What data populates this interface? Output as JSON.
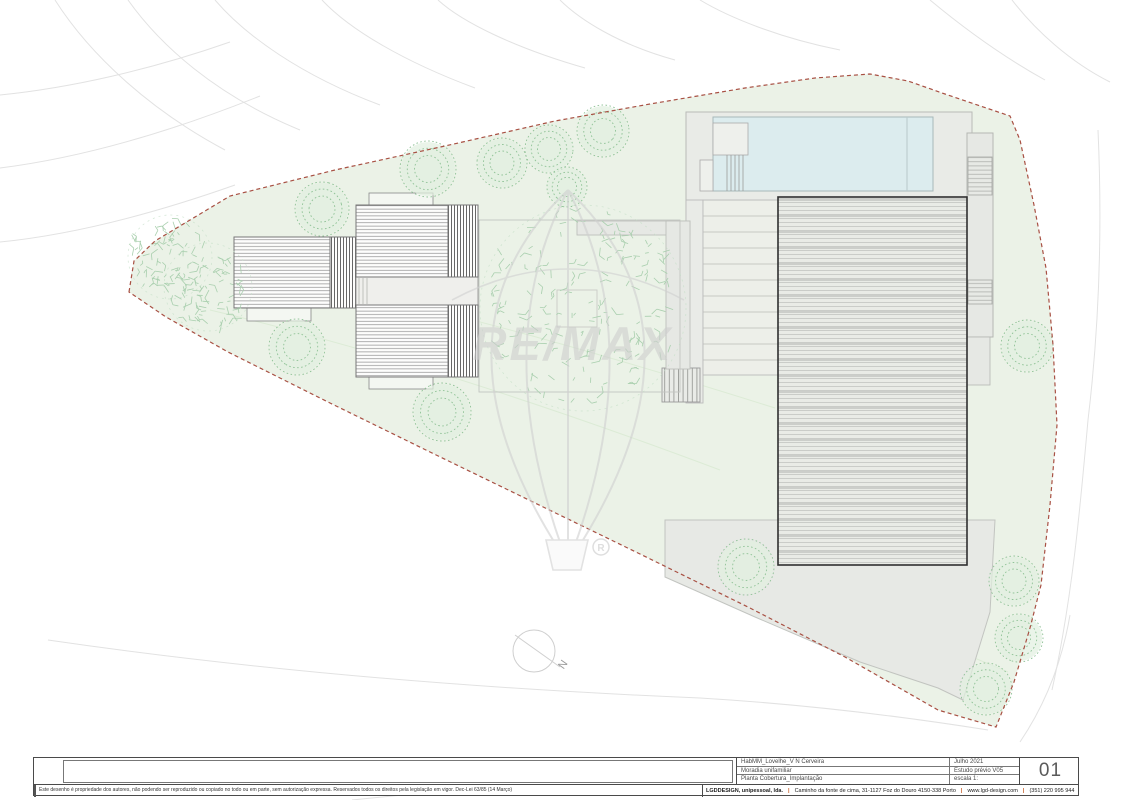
{
  "meta": {
    "sheet_number": "01",
    "north_label": "N"
  },
  "watermark": {
    "brand": "RE/MAX",
    "registered": "R"
  },
  "title_block": {
    "project": "HabMM_Lovelhe_V N Cerveira",
    "building_type": "Moradia unifamiliar",
    "drawing_title": "Planta Cobertura_Implantação",
    "date": "Julho 2021",
    "phase": "Estudo prévio V05",
    "scale": "escala 1:",
    "sheet_number": "01",
    "disclaimer": "Este desenho é propriedade dos autores, não podendo ser reproduzido ou copiado no todo ou em parte, sem autorização expressa. Reservados todos os direitos pela legislação em vigor. Dec-Lei 63/85 (14 Março)",
    "company": "LGDDESIGN, unipessoal, lda.",
    "address": "Caminho da fonte de cima, 31-1127   Foz do Douro   4150-338 Porto",
    "website": "www.lgd-design.com",
    "phone": "(351) 220 995 944",
    "separator": "|"
  },
  "palette": {
    "site_green": "#ebf2e7",
    "boundary_red": "#a85043",
    "pool_blue": "#dcecee",
    "roof_gray": "#e9ebe6",
    "tree_green": "#8fc296",
    "sketch_green": "#a9cfae",
    "contour_gray": "#e2e2e2",
    "watermark_gray": "#d0d0d0"
  },
  "drawing": {
    "site_polygon": "129,292 134,261 155,241 230,196 335,170 445,146 555,121 650,104 745,88 815,78 870,74 908,81 945,94 1010,116 1020,140 1034,205 1046,268 1053,345 1057,425 1050,505 1041,585 1030,628 1014,682 996,727 938,710 845,657 748,607 640,554 535,503 430,452 330,403 228,352 166,317",
    "contours": [
      "M 55,0 C 90,55 150,110 225,150",
      "M 128,0 C 160,45 215,95 300,130",
      "M 215,0 C 245,35 300,75 380,105",
      "M 322,0 C 350,30 405,62 475,88",
      "M 438,0 C 462,22 515,48 585,68",
      "M 0,95 C 70,88 150,70 230,42",
      "M 0,168 C 80,158 170,132 260,96",
      "M 0,242 C 70,235 150,215 235,185",
      "M 560,0 C 580,20 620,45 675,60",
      "M 700,0 C 730,18 780,38 840,50",
      "M 930,0 C 960,25 1000,55 1045,80",
      "M 1012,0 C 1035,30 1070,62 1110,82",
      "M 1098,130 C 1102,220 1100,320 1088,420",
      "M 1088,420 C 1080,510 1072,600 1052,690",
      "M 48,640 C 240,668 460,688 700,698",
      "M 700,698 C 800,704 900,716 988,730",
      "M 72,758 C 280,766 500,770 710,764",
      "M 352,800 C 470,788 600,778 716,770",
      "M 1020,742 C 1045,705 1062,662 1070,615"
    ],
    "green_contours": [
      "M 210,310 C 380,350 560,410 720,470",
      "M 262,272 C 430,304 610,356 775,408",
      "M 820,600 C 900,626 960,652 1008,672"
    ],
    "trees_round": [
      {
        "x": 322,
        "y": 209,
        "r": 27
      },
      {
        "x": 428,
        "y": 169,
        "r": 28
      },
      {
        "x": 502,
        "y": 163,
        "r": 25
      },
      {
        "x": 549,
        "y": 149,
        "r": 24
      },
      {
        "x": 603,
        "y": 131,
        "r": 26
      },
      {
        "x": 567,
        "y": 187,
        "r": 20
      },
      {
        "x": 297,
        "y": 347,
        "r": 28
      },
      {
        "x": 442,
        "y": 412,
        "r": 29
      },
      {
        "x": 746,
        "y": 567,
        "r": 28
      },
      {
        "x": 1027,
        "y": 346,
        "r": 26
      },
      {
        "x": 1014,
        "y": 581,
        "r": 25
      },
      {
        "x": 1019,
        "y": 638,
        "r": 24
      },
      {
        "x": 986,
        "y": 689,
        "r": 26
      }
    ],
    "trees_sketch": [
      {
        "x": 170,
        "y": 257,
        "r": 42
      },
      {
        "x": 208,
        "y": 287,
        "r": 44
      },
      {
        "x": 583,
        "y": 308,
        "r": 103
      }
    ]
  }
}
